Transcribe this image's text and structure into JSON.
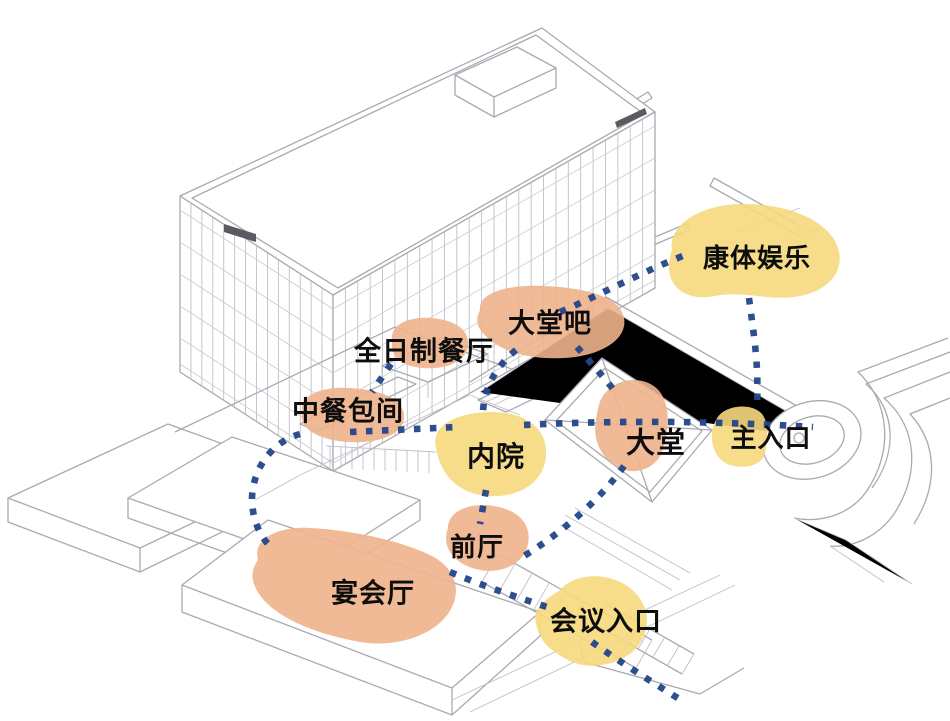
{
  "diagram": {
    "title": "hotel-program-and-circulation-axonometric",
    "colors": {
      "zone_orange": "#F0B28C",
      "zone_yellow": "#F6D87C",
      "path_blue": "#24478A",
      "line_gray": "#A9A9B2",
      "text": "#0D0D0D"
    },
    "zones": [
      {
        "id": "fitness-recreation",
        "label": "康体娱乐",
        "color": "yellow"
      },
      {
        "id": "lobby-bar",
        "label": "大堂吧",
        "color": "orange"
      },
      {
        "id": "all-day-dining",
        "label": "全日制餐厅",
        "color": "orange"
      },
      {
        "id": "chinese-private-dining",
        "label": "中餐包间",
        "color": "orange"
      },
      {
        "id": "inner-courtyard",
        "label": "内院",
        "color": "yellow"
      },
      {
        "id": "lobby",
        "label": "大堂",
        "color": "orange"
      },
      {
        "id": "main-entrance",
        "label": "主入口",
        "color": "yellow"
      },
      {
        "id": "front-hall",
        "label": "前厅",
        "color": "orange"
      },
      {
        "id": "banquet-hall",
        "label": "宴会厅",
        "color": "orange"
      },
      {
        "id": "conference-entrance",
        "label": "会议入口",
        "color": "yellow"
      }
    ],
    "connections": [
      {
        "from": "chinese-private-dining",
        "to": "inner-courtyard"
      },
      {
        "from": "inner-courtyard",
        "to": "main-entrance"
      },
      {
        "from": "lobby-bar",
        "to": "fitness-recreation"
      },
      {
        "from": "fitness-recreation",
        "to": "main-entrance"
      },
      {
        "from": "lobby-bar",
        "to": "lobby"
      },
      {
        "from": "lobby-bar",
        "to": "inner-courtyard"
      },
      {
        "from": "all-day-dining",
        "to": "chinese-private-dining"
      },
      {
        "from": "chinese-private-dining",
        "to": "banquet-hall"
      },
      {
        "from": "inner-courtyard",
        "to": "front-hall"
      },
      {
        "from": "lobby",
        "to": "front-hall"
      },
      {
        "from": "front-hall",
        "to": "conference-entrance"
      },
      {
        "from": "conference-entrance",
        "to": "site-exit"
      }
    ]
  }
}
